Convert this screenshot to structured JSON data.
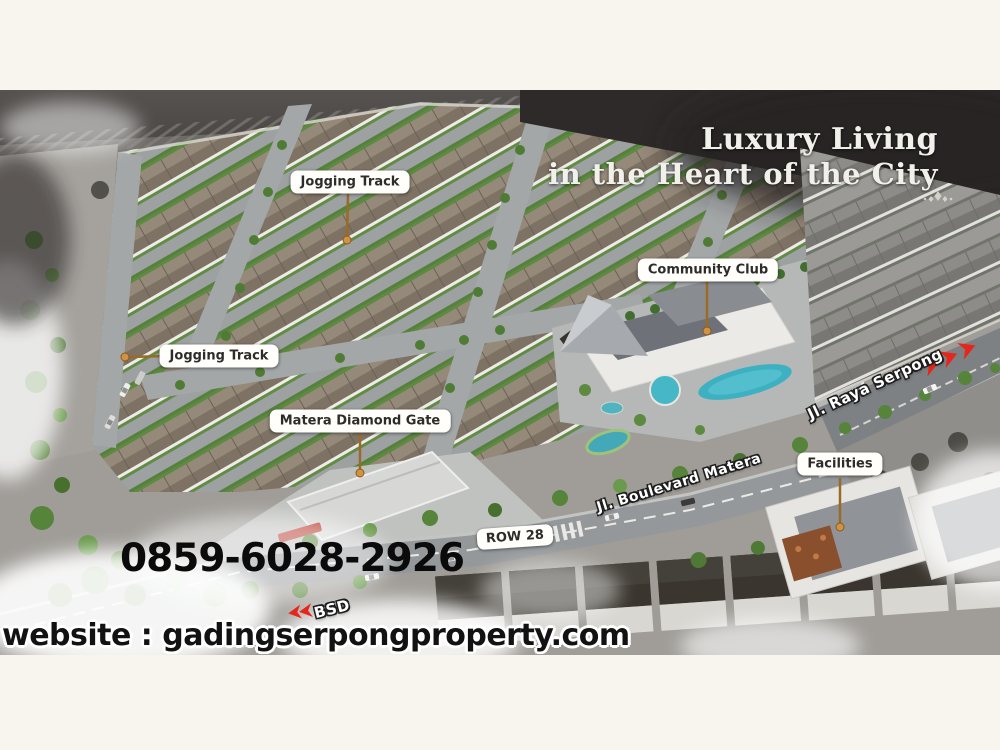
{
  "headline": {
    "line1": "Luxury Living",
    "line2": "in the Heart of the City"
  },
  "callouts": [
    {
      "id": "jogging-track-north",
      "label": "Jogging Track"
    },
    {
      "id": "community-club",
      "label": "Community Club"
    },
    {
      "id": "jogging-track-west",
      "label": "Jogging Track"
    },
    {
      "id": "matera-diamond-gate",
      "label": "Matera Diamond Gate"
    },
    {
      "id": "facilities",
      "label": "Facilities"
    },
    {
      "id": "row-28",
      "label": "ROW 28"
    }
  ],
  "street_labels": [
    {
      "id": "jl-raya-serpong",
      "label": "Jl. Raya Serpong"
    },
    {
      "id": "jl-boulevard-matera",
      "label": "Jl. Boulevard Matera"
    },
    {
      "id": "bsd",
      "label": "BSD"
    }
  ],
  "contact": {
    "phone": "0859-6028-2926",
    "website": "website : gadingserpongproperty.com"
  },
  "colors": {
    "canvas_cream": "#f8f5ee",
    "accent_red": "#e6261b",
    "callout_bg": "#fffefb",
    "callout_text": "#2d2c2b",
    "pin_brown": "#c08a3e",
    "headline_text": "#f2f0ea",
    "pool_teal": "#3db0c2"
  },
  "icons": [
    {
      "name": "direction-arrows-east-icon",
      "meaning": "red chevrons along Jl. Raya Serpong"
    },
    {
      "name": "direction-arrow-bsd-icon",
      "meaning": "red chevrons toward BSD"
    },
    {
      "name": "divider-ornament-icon",
      "meaning": "decorative fleuron ending headline rule"
    }
  ]
}
